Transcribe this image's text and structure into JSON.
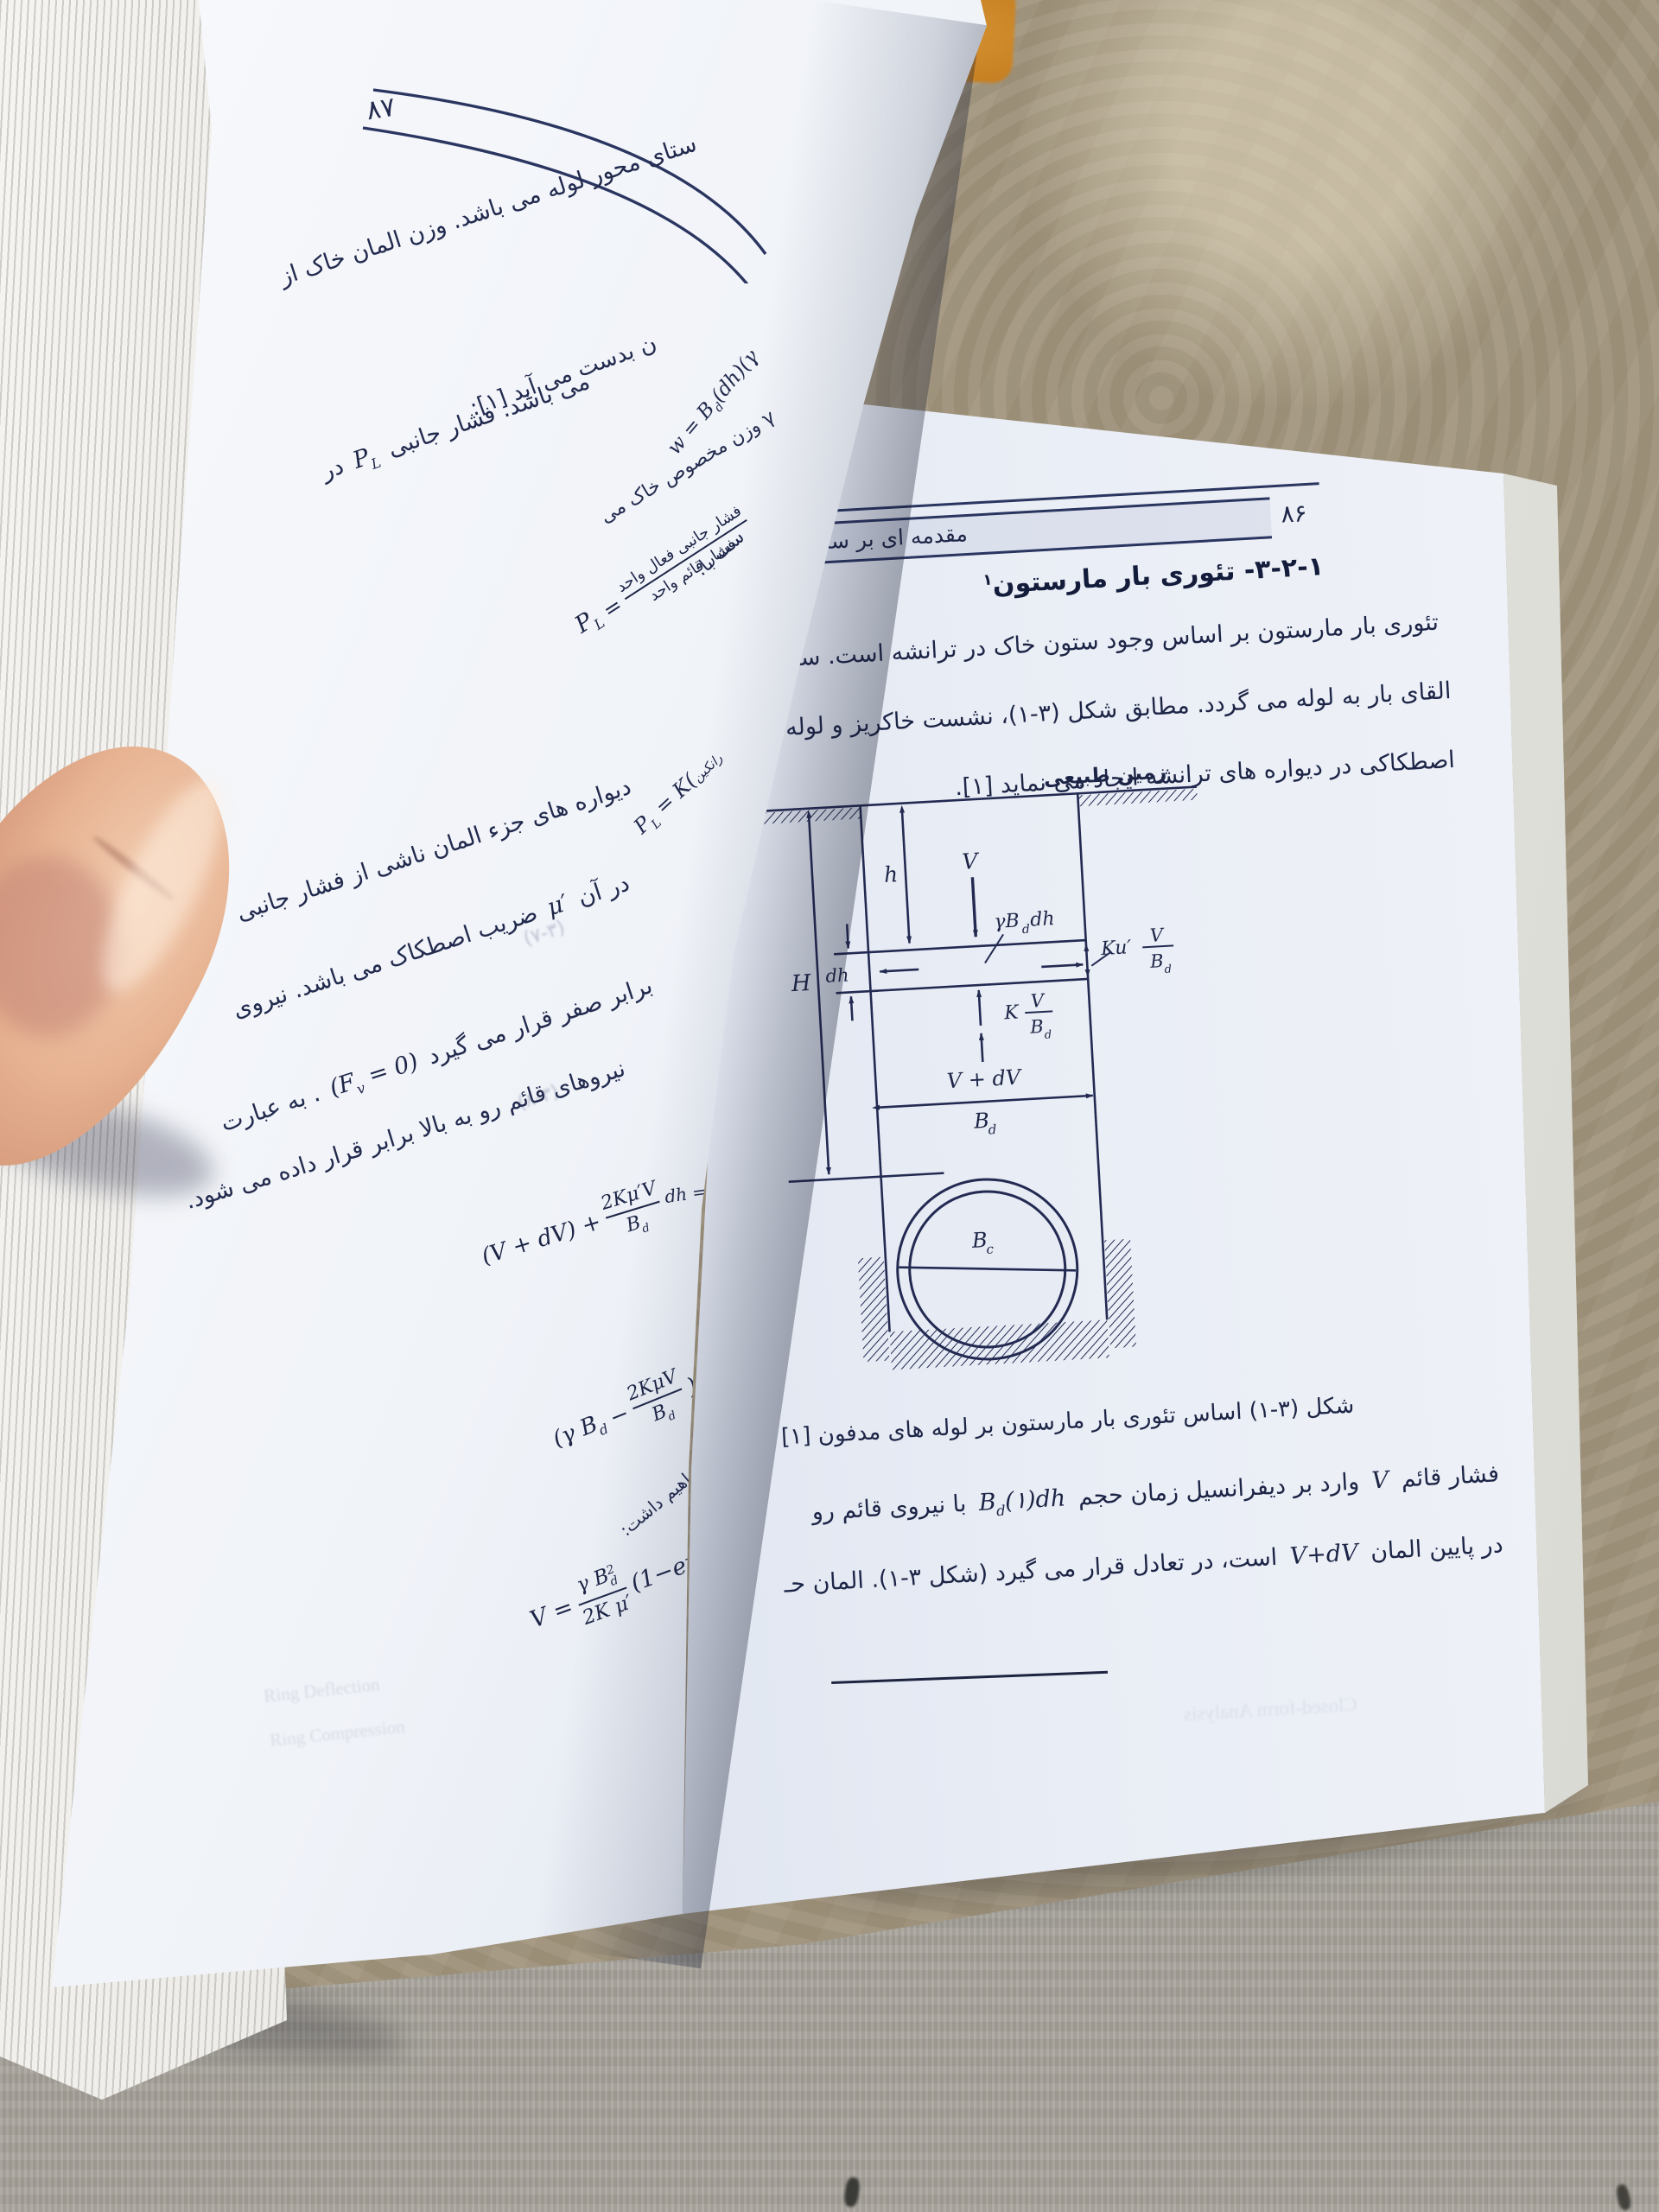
{
  "colors": {
    "ink": "#1d2547",
    "rule": "#2a3560",
    "wall": "#a2967f",
    "table": "#a8a49c",
    "paper": "#eef1f7"
  },
  "right_page": {
    "page_number": "۸۶",
    "running_title": "مقدمه ای بر سازه های خاک",
    "heading": {
      "text": "۳-۲-۱- تئوری بار مارستون",
      "footnote_mark": "۱"
    },
    "paragraph1": [
      "تئوری بار مارستون بر اساس وجود ستون خاک در ترانشه است. ستون خا",
      "القای بار به لوله می گردد. مطابق شکل (۳-۱)، نشست خاکریز و لوله، نیروهای",
      "اصطکاکی در دیواره های ترانشه ایجاد می نماید [۱]."
    ],
    "diagram": {
      "ground_label": "زمین طبیعی",
      "H": "H",
      "h": "h",
      "V": "V",
      "dh": "dh",
      "gamma_label": "γB",
      "gamma_sub": "d",
      "gamma_tail": " dh",
      "ku_coef": "Ku′",
      "ku_num": "V",
      "ku_den": "B",
      "ku_den_sub": "d",
      "k_coef": "K",
      "k_num": "V",
      "k_den": "B",
      "k_den_sub": "d",
      "v_dv": "V + dV",
      "bd": "B",
      "bd_sub": "d",
      "bc": "B",
      "bc_sub": "c"
    },
    "caption": "شکل (۳-۱) اساس تئوری بار مارستون بر لوله های مدفون [۱]",
    "paragraph2": {
      "l1a": "فشار قائم",
      "l1m1": "V",
      "l1b": "وارد بر دیفرانسیل زمان حجم",
      "l1m2": "B",
      "l1m2sub": "d",
      "l1m2tail": "(۱)dh",
      "l1c": "با نیروی قائم رو",
      "l2a": "در پایین المان",
      "l2m": "V+dV",
      "l2b": "است، در تعادل قرار می گیرد (شکل ۳-۱). المان حـ"
    },
    "show_through": "Closed-form Analysis"
  },
  "left_page": {
    "page_number": "۸۷",
    "lines": {
      "l1": "ستای محور لوله می باشد. وزن المان خاک از",
      "w_eq": {
        "lhs": "w = B",
        "sub": "d",
        "tail": "(dh)(γ"
      },
      "frag_gamma": "γ وزن مخصوص خاک می",
      "frag_ast": "ست با:",
      "l2": "ن بدست می آید [۱]:",
      "pl_frac": {
        "p": "P",
        "sub": "L",
        "eq": "=",
        "num": "فشار جانبی فعال واحد",
        "den": "فشار قائم واحد"
      },
      "pl_k": {
        "p": "P",
        "sub": "L",
        "rest": "= K(",
        "paren": "رانکین"
      },
      "l3": "می باشد. فشار جانبی",
      "l3m": "P",
      "l3msub": "L",
      "l3tail": "در",
      "l4": "دیواره های جزء المان ناشی از فشار جانبی",
      "l5a": "در آن",
      "l5m": "μ′",
      "l5b": "ضریب اصطکاک می باشد. نیروی",
      "l6a": "برابر صفر قرار می گیرد",
      "l6m_open": "(F",
      "l6m_sub": "v",
      "l6m_close": " = 0)",
      "l6b": ". به عبارت",
      "l7": "نیروهای قائم رو به بالا برابر قرار داده می شود.",
      "eqnum1": "(۷-۳)",
      "eqnum2": "(۸-۳)",
      "eq_vdv": {
        "open": "(V + dV) +",
        "num": "2Kμ′V",
        "den": "B",
        "den_sub": "d",
        "tail": "dh = V"
      },
      "eq_gbd": {
        "open": "(γ B",
        "open_sub": "d",
        "minus": "−",
        "num": "2KμV",
        "den": "B",
        "den_sub": "d",
        "close": ")",
        "tail_num": "dh",
        "tail_den": "dv"
      },
      "frag_have": "خواهیم داشت:",
      "eq_v": {
        "lhs": "V =",
        "num": "γ B",
        "num_sub": "d",
        "num_sup": "2",
        "den": "2K μ′",
        "tail": "(1−e",
        "tail_sup": "−⋯"
      },
      "show_through1": "Ring Deflection",
      "show_through2": "Ring Compression"
    }
  }
}
